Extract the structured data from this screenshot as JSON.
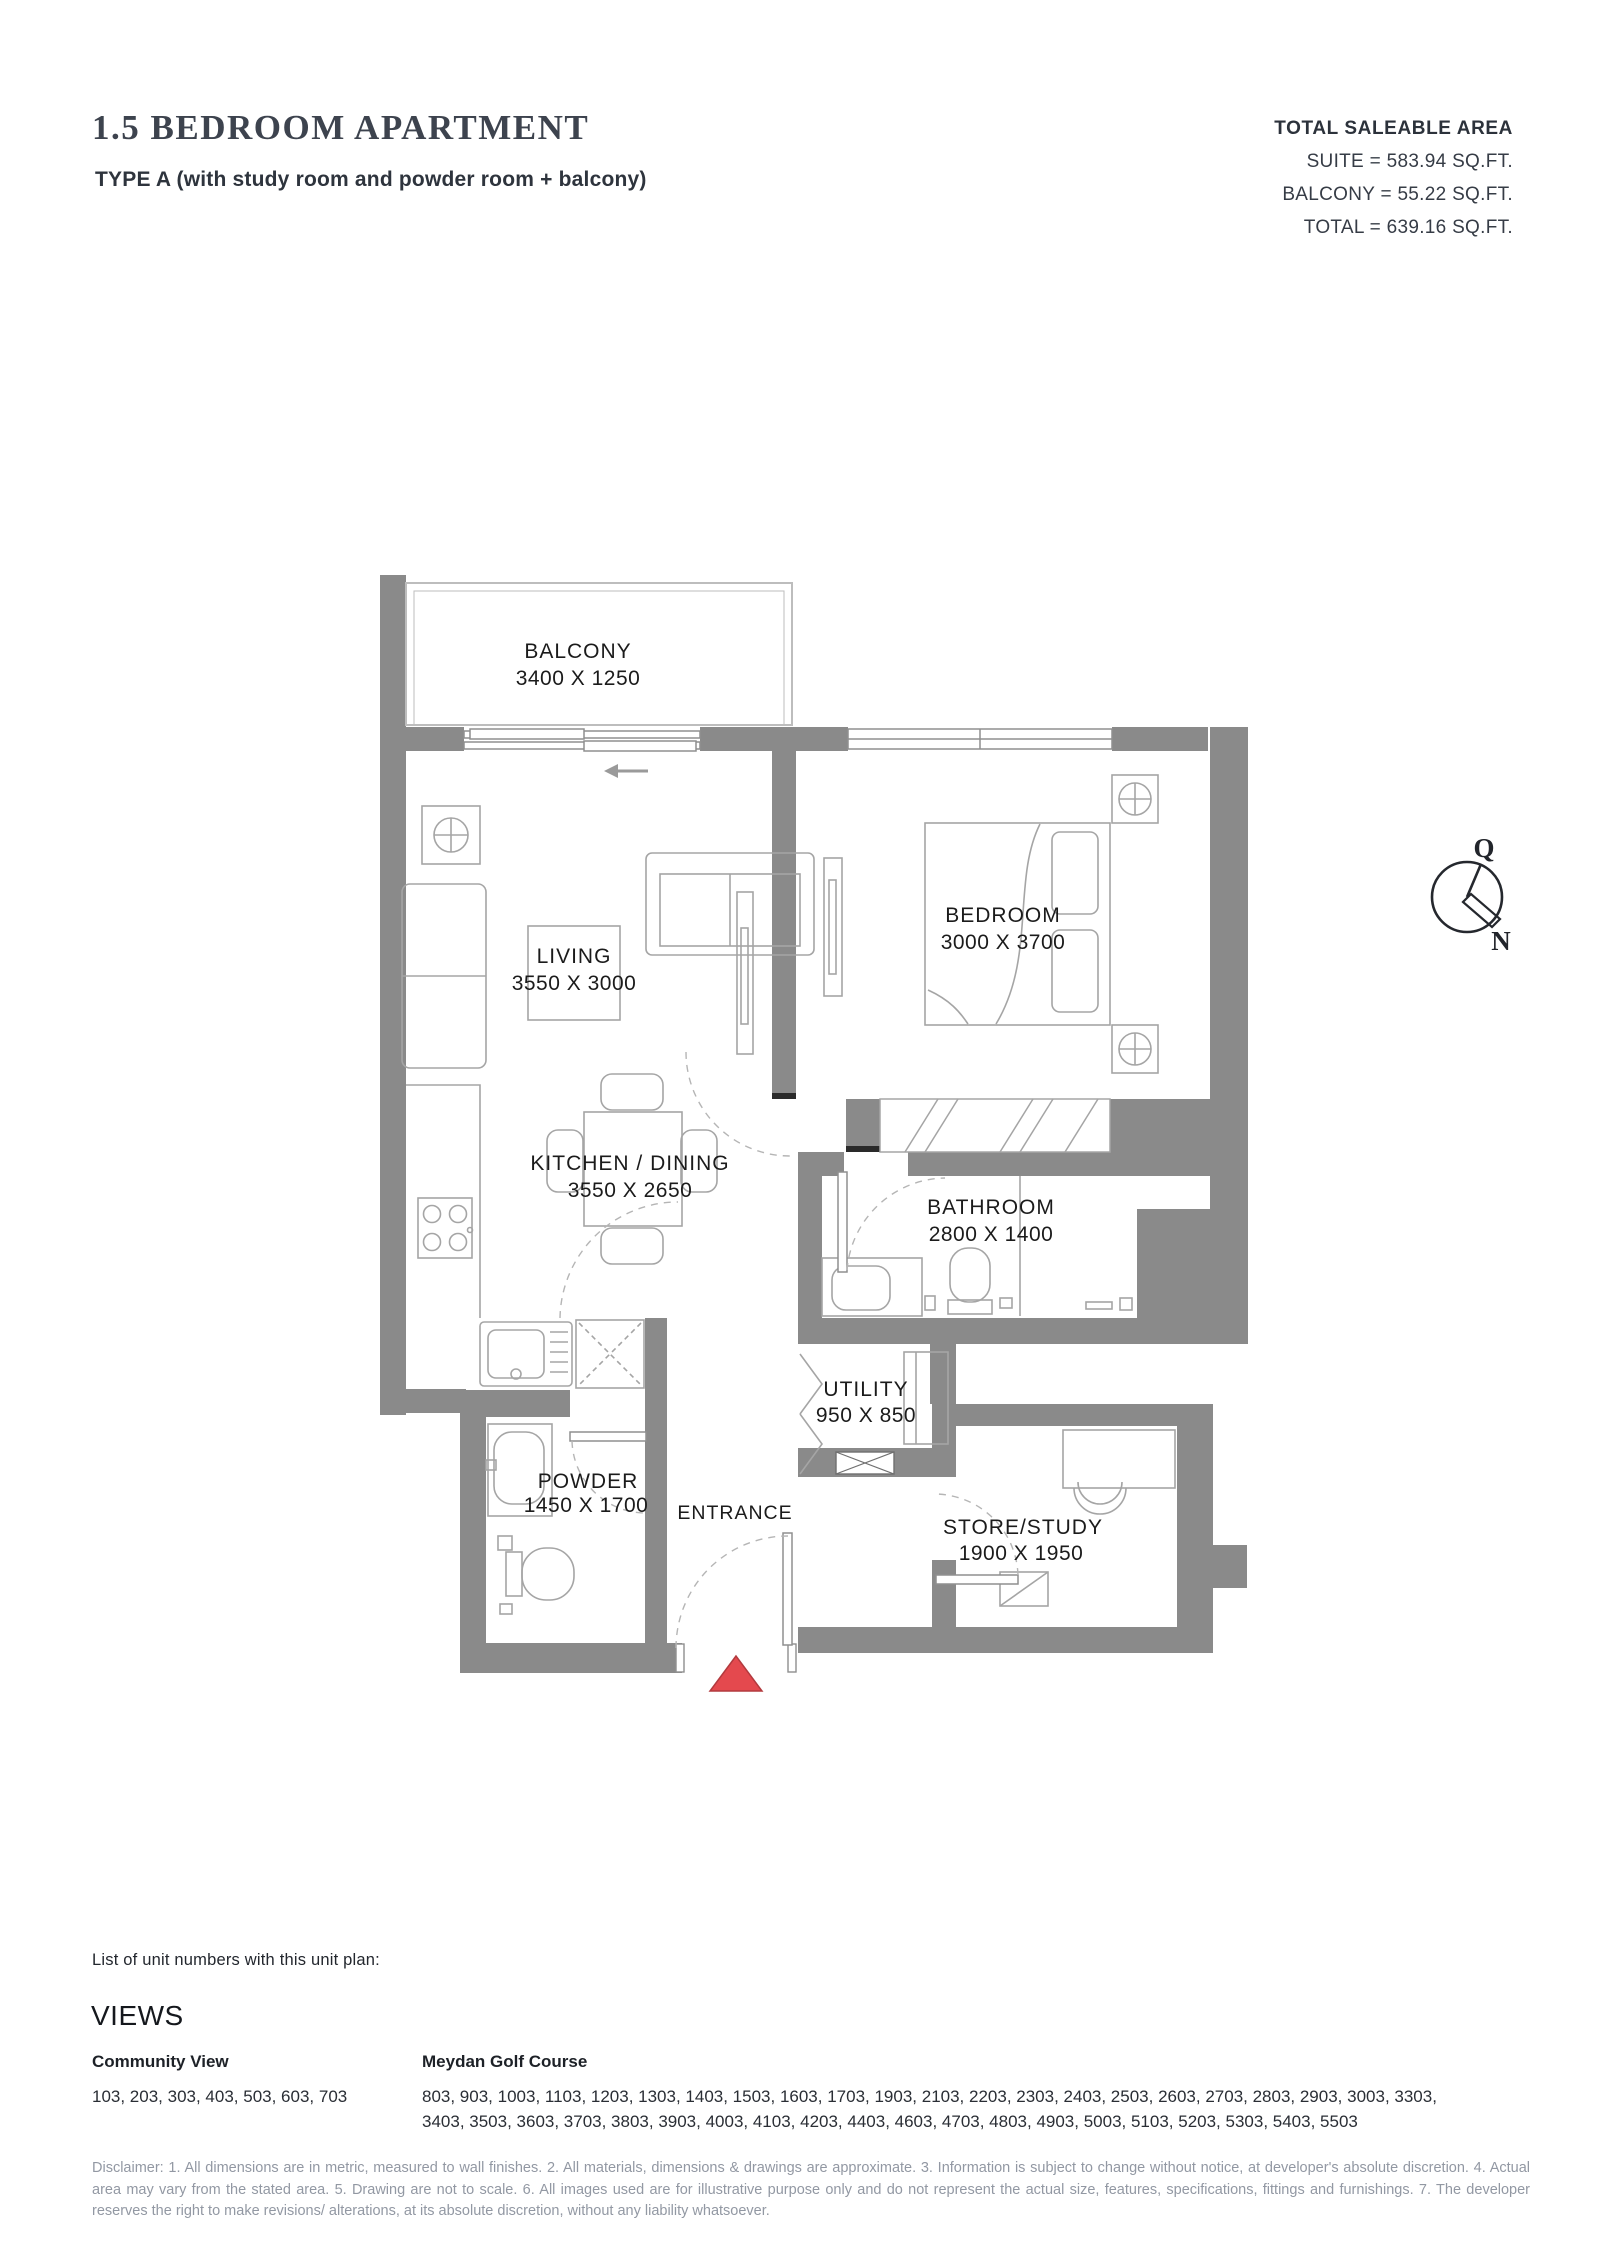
{
  "header": {
    "title": "1.5 BEDROOM APARTMENT",
    "subtitle": "TYPE A (with study room and powder room + balcony)"
  },
  "area_summary": {
    "heading": "TOTAL SALEABLE AREA",
    "lines": [
      "SUITE = 583.94 SQ.FT.",
      "BALCONY = 55.22 SQ.FT.",
      "TOTAL = 639.16 SQ.FT."
    ]
  },
  "floor_plan": {
    "rooms": [
      {
        "name": "BALCONY",
        "dims": "3400 X 1250"
      },
      {
        "name": "LIVING",
        "dims": "3550 X 3000"
      },
      {
        "name": "BEDROOM",
        "dims": "3000 X 3700"
      },
      {
        "name": "KITCHEN / DINING",
        "dims": "3550 X 2650"
      },
      {
        "name": "BATHROOM",
        "dims": "2800 X 1400"
      },
      {
        "name": "UTILITY",
        "dims": "950 X 850"
      },
      {
        "name": "POWDER",
        "dims": "1450 X 1700"
      },
      {
        "name": "STORE/STUDY",
        "dims": "1900 X 1950"
      }
    ],
    "entrance_label": "ENTRANCE",
    "compass": {
      "qibla_label": "Q",
      "north_label": "N"
    }
  },
  "unit_numbers": {
    "intro": "List of unit numbers with this unit plan:",
    "views_heading": "VIEWS",
    "columns": [
      {
        "title": "Community View",
        "lines": [
          "103, 203, 303, 403, 503, 603, 703"
        ]
      },
      {
        "title": "Meydan Golf Course",
        "lines": [
          "803, 903, 1003, 1103, 1203, 1303, 1403, 1503, 1603, 1703, 1903, 2103, 2203, 2303, 2403, 2503, 2603, 2703, 2803, 2903, 3003, 3303,",
          "3403, 3503, 3603, 3703, 3803, 3903, 4003, 4103, 4203, 4403, 4603, 4703, 4803, 4903, 5003, 5103, 5203, 5303, 5403, 5503"
        ]
      }
    ]
  },
  "disclaimer": "Disclaimer: 1. All dimensions are in metric, measured to wall finishes. 2. All materials, dimensions & drawings are approximate. 3. Information is subject to change without notice, at developer's absolute discretion. 4. Actual area may vary from the stated area. 5. Drawing are not to scale. 6. All images used are for illustrative purpose only and do not represent the actual size, features, specifications, fittings and furnishings. 7. The developer reserves the right to make revisions/ alterations, at its absolute discretion, without any liability whatsoever.",
  "colors": {
    "wall": "#8a8a8a",
    "furniture_line": "#a5a5a5",
    "entrance_marker": "#e4494e",
    "title_text": "#3d434e",
    "disclaimer_text": "#9298a3"
  }
}
